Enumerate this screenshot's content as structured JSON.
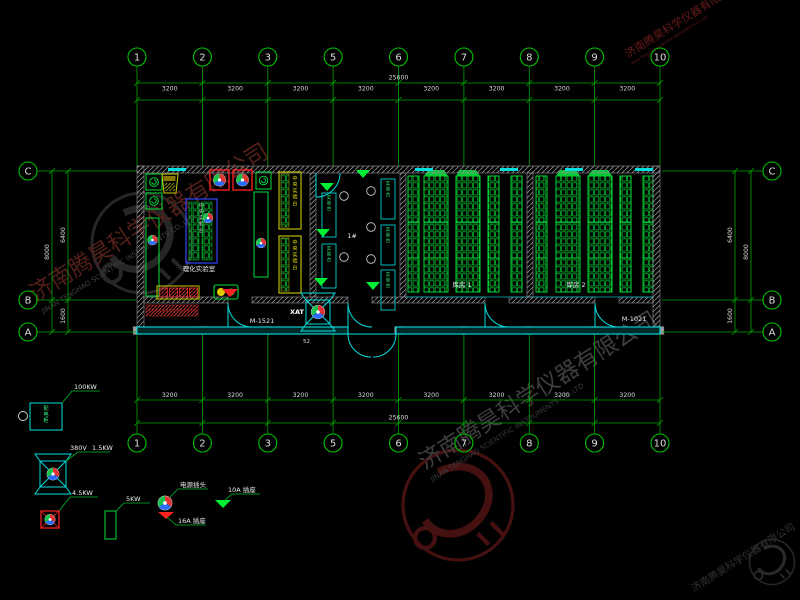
{
  "drawing": {
    "grid": {
      "axis_labels": [
        "1",
        "2",
        "3",
        "5",
        "6",
        "7",
        "8",
        "9",
        "10"
      ],
      "row_labels": [
        "C",
        "B",
        "A"
      ],
      "segment_dim": "3200",
      "total_dim": "25600",
      "row_dim_total": "8000",
      "row_dim_upper": "6400",
      "row_dim_lower": "1600"
    },
    "rooms": {
      "left_room_label": "理化实验室",
      "mid_room_label": "1#",
      "room1_label": "库房 1",
      "room2_label": "库房 2",
      "central_bench_label": "中央实验台",
      "side_bench_label": "中央实验台",
      "unit_bench_label": "实验台"
    },
    "annotations": {
      "left_door_tag": "M-1521",
      "right_door_tag": "M-1021",
      "fan_tag": "XAT",
      "entry_num": "52"
    },
    "legend": {
      "cabinet_text": "配电柜",
      "cabinet_power": "100KW",
      "fan_voltage": "380V",
      "fan_power": "1.5KW",
      "small_fan_power": "4.5KW",
      "bench_power": "5KW",
      "plug_label": "电源插头",
      "socket16_label": "16A 插座",
      "socket10_label": "10A 插座"
    },
    "watermark": {
      "cn": "济南腾昊科学仪器有限公司",
      "en": "JINAN TENGHAO SCIENTIFIC INSTRUMENTS CO.,LTD"
    },
    "colors": {
      "grid_green": "#00a400",
      "wall_cyan": "#00dede",
      "bench_green": "#00dd33",
      "alarm_red": "#ff2222",
      "bench_yellow": "#cccc00",
      "bench_blue": "#3344ff",
      "watermark_red": "#6e2a22",
      "watermark_gray": "#4e4e4e"
    }
  }
}
